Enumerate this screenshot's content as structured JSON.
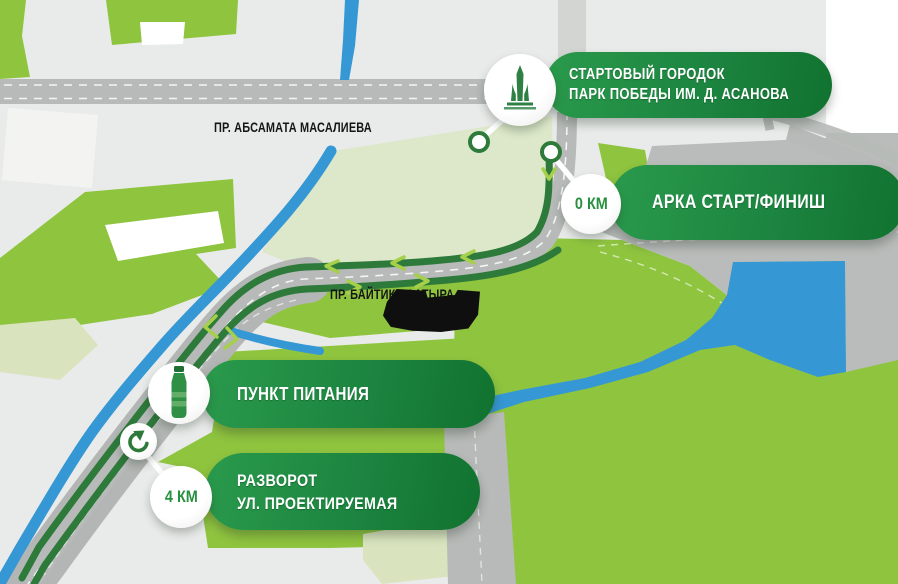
{
  "legend": {
    "start": {
      "line1": "СТАРТОВЫЙ ГОРОДОК",
      "line2": "ПАРК ПОБЕДЫ ИМ. Д. АСАНОВА",
      "icon": "monument-icon"
    },
    "arch": {
      "km": "0 КМ",
      "title": "АРКА СТАРТ/ФИНИШ"
    },
    "food": {
      "title": "ПУНКТ ПИТАНИЯ",
      "icon": "bottle-icon"
    },
    "turnaround": {
      "km": "4 КМ",
      "line1": "РАЗВОРОТ",
      "line2": "УЛ. ПРОЕКТИРУЕМАЯ",
      "icon": "u-turn-icon"
    }
  },
  "streets": {
    "masaliev": "ПР. АБСАМАТА МАСАЛИЕВА",
    "baytik": "ПР. БАЙТИК БААТЫРА"
  },
  "colors": {
    "pill_light": "#2a9a4c",
    "pill_dark": "#11722f",
    "map_green": "#8fc43f",
    "map_pale_green": "#dde8ca",
    "water_blue": "#3598d4",
    "route_green": "#2d7a3b",
    "arrow_green": "#a6cf4a",
    "road_gray": "#b7bab8",
    "corridor_gray": "#b3b6b4",
    "gray_zone": "#b9bcba",
    "bg_gray": "#e9ebea",
    "km_green": "#28913f",
    "street_black": "#151515"
  }
}
